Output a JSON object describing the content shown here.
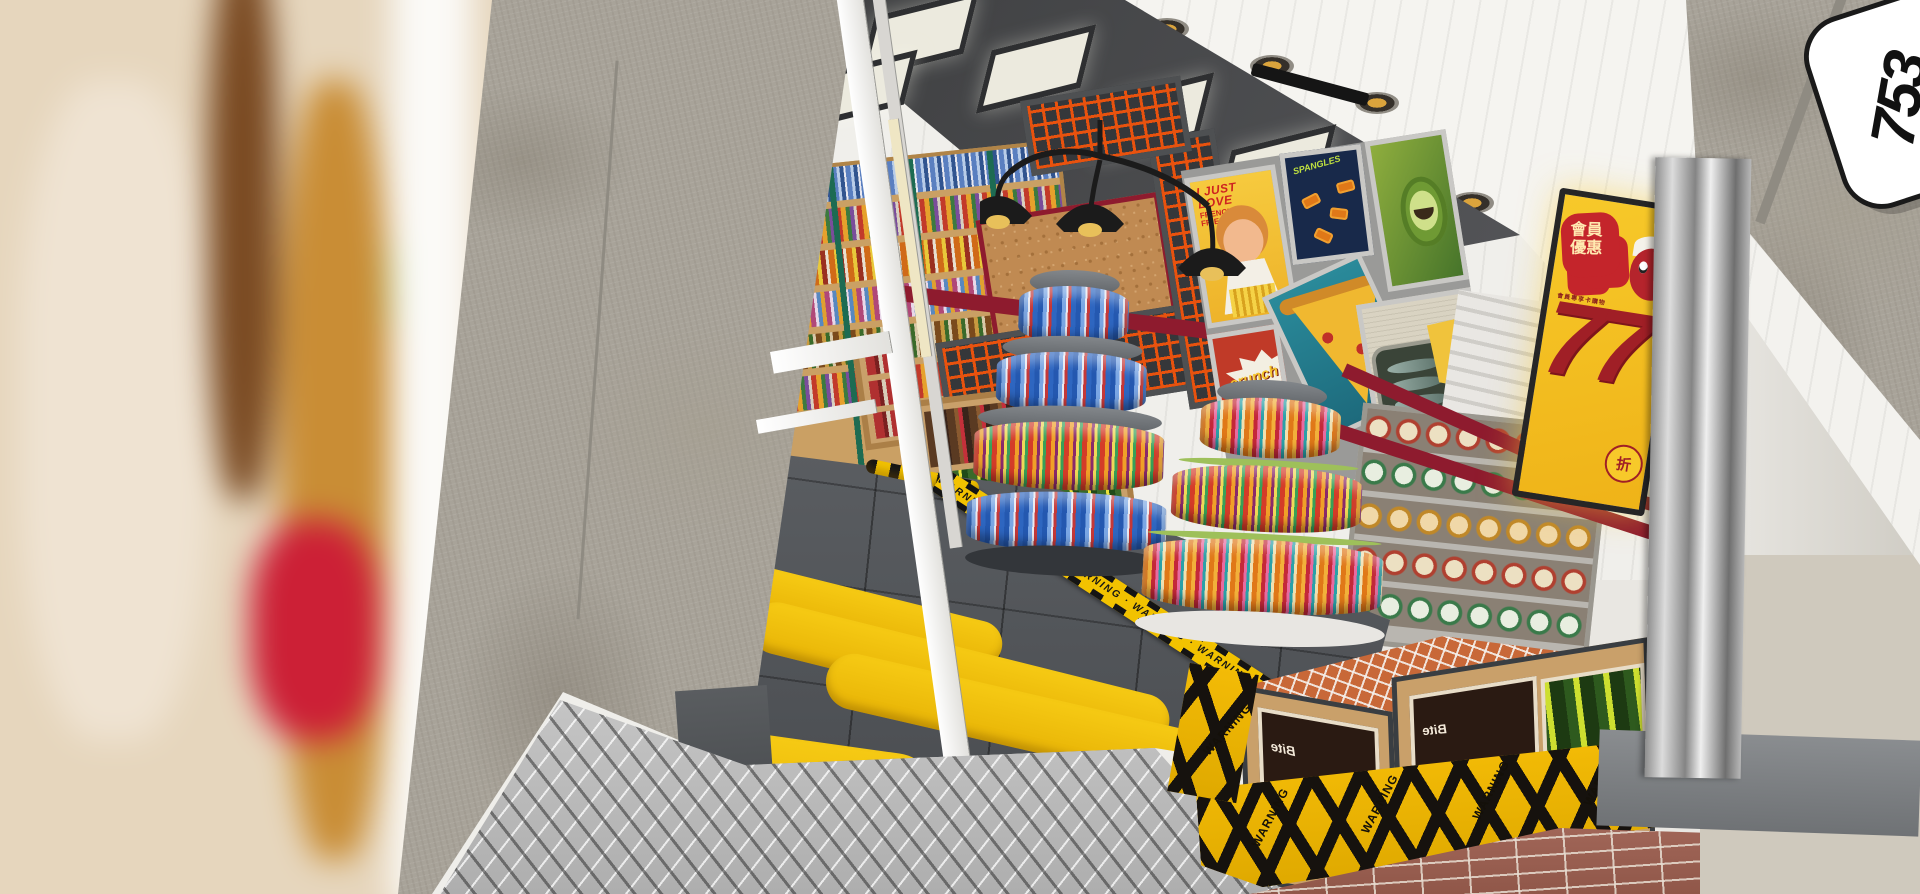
{
  "scene": {
    "description": "3D rendering of a convenience store entrance with snack displays, retro poster wall and warning-striped threshold"
  },
  "signage": {
    "storefront_logo": "753",
    "lightbox": {
      "headline": "會員優惠",
      "subline": "會員專享卡購物",
      "number": "77",
      "unit": "折"
    },
    "tape_text": "WARNING · WARNING · WARNING · WARNING · WARNING ·",
    "curb_word": "WARNING"
  },
  "posters": [
    {
      "id": "fries",
      "line1": "I JUST LOVE",
      "line2": "FRENCH",
      "line3": "FRIES"
    },
    {
      "id": "candy",
      "label": "SPANGLES"
    },
    {
      "id": "avocado",
      "label": ""
    },
    {
      "id": "crunch",
      "label": "crunch"
    },
    {
      "id": "pizza",
      "label": ""
    },
    {
      "id": "sardines",
      "label": ""
    }
  ],
  "products": {
    "chocolate_brand": "Bite"
  },
  "colors": {
    "accent_yellow": "#F4C400",
    "lightbox_yellow": "#F5C21F",
    "sign_red": "#C4252B",
    "maroon_band": "#8E1B2E",
    "mesh_orange": "#E8520E",
    "floor_gray": "#55585C",
    "concrete": "#A8A399",
    "brick": "#9C5A4C",
    "shelf_green": "#1D6B52"
  }
}
